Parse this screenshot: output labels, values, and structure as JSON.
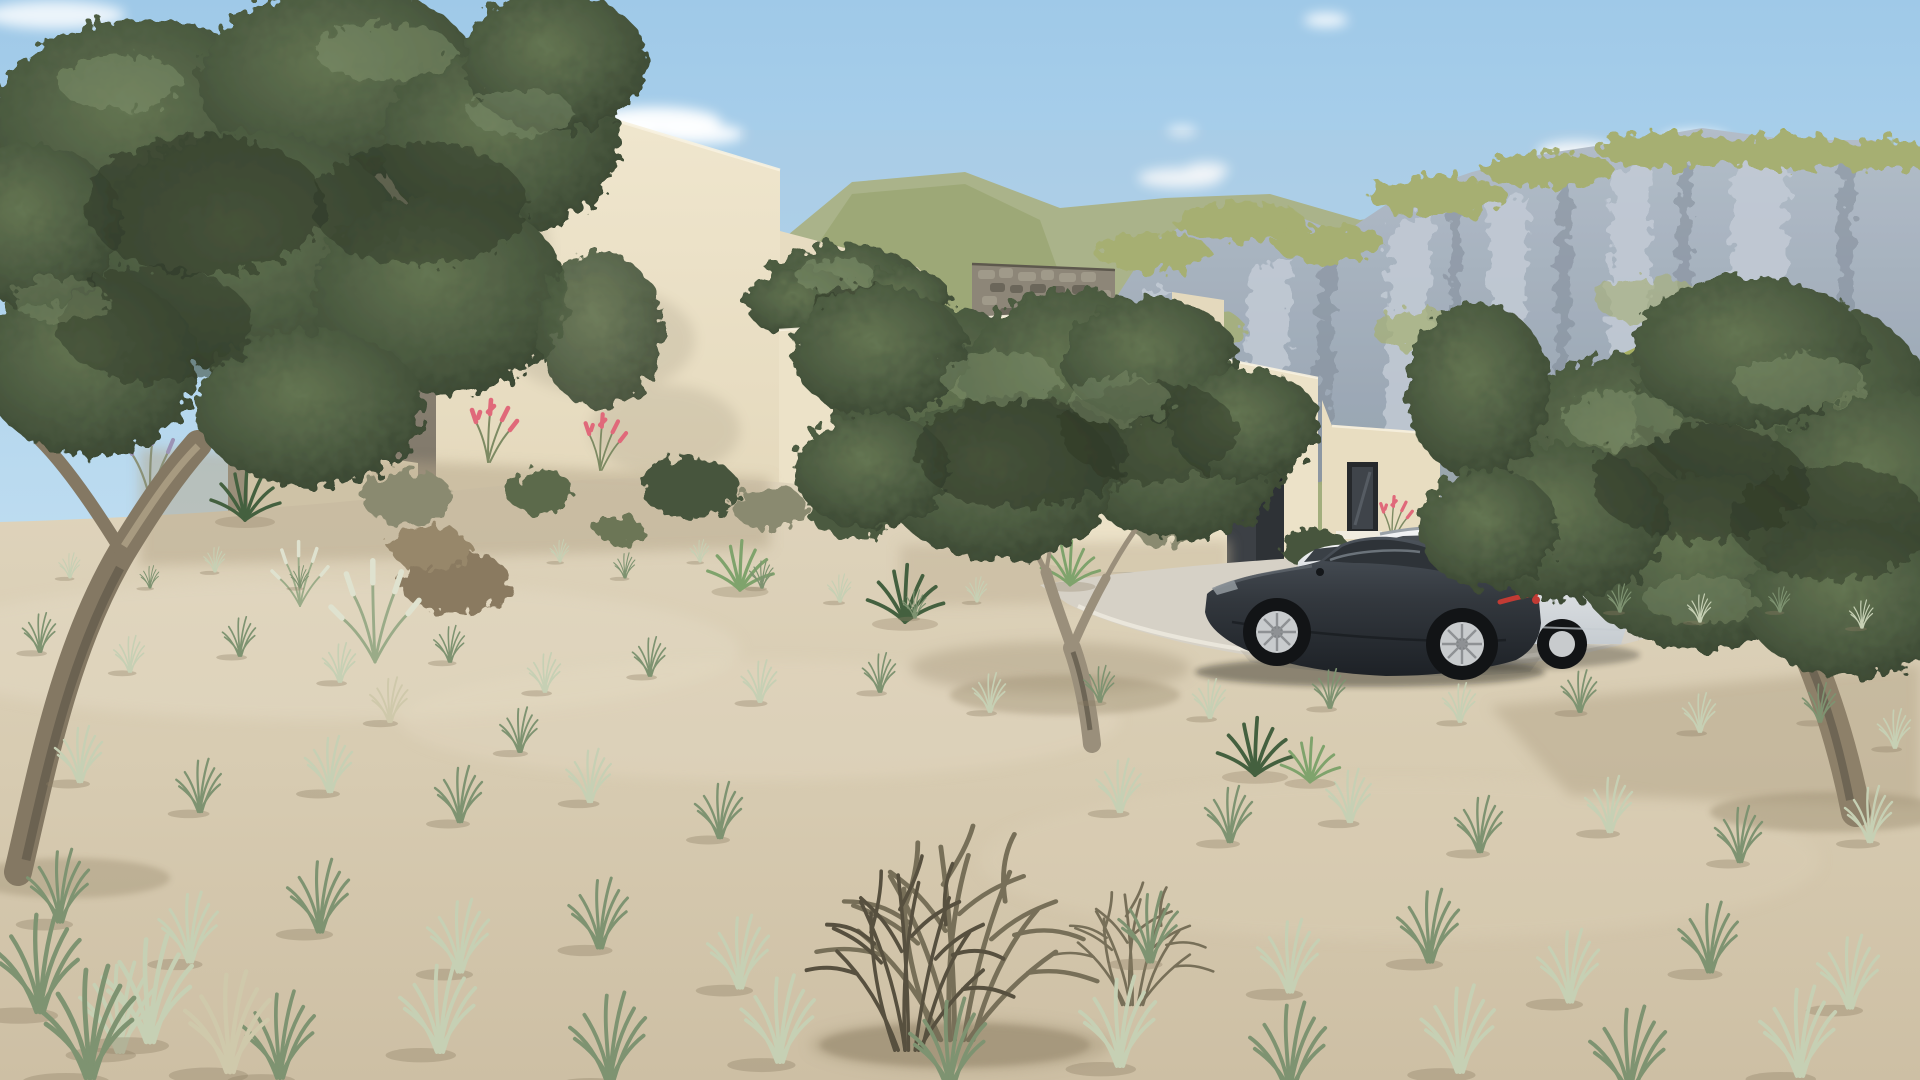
{
  "scene": {
    "title": "Photoreal 3D exterior rendering of a flat-roofed modern stucco villa on an arid hillside with olive trees, desert grasses, rocky green mountains and parked cars",
    "environment": {
      "sky": "clear light-blue sky with a few small white clouds",
      "background": "rocky limestone mountain range with olive-green grassy slopes",
      "midground": "cream stepped single-storey villa volumes, stone accent wall, concrete driveway",
      "foreground": "pale sandy ground with sparse desert grass tufts, dry shrub and gnarled olive trees"
    },
    "objects": [
      {
        "id": "villa",
        "label": "modern cream stucco villa with stepped flat-roofed volumes"
      },
      {
        "id": "roof-overhang",
        "label": "projecting flat roof slab on tall left volume"
      },
      {
        "id": "garage-door",
        "label": "dark recessed garage opening"
      },
      {
        "id": "vertical-window",
        "label": "tall dark-framed window on right wing"
      },
      {
        "id": "stone-wall",
        "label": "rubble stone accent wall behind courtyard"
      },
      {
        "id": "courtyard-trees",
        "label": "green tree crowns rising above courtyard walls"
      },
      {
        "id": "driveway",
        "label": "light concrete parking apron"
      },
      {
        "id": "sports-car",
        "label": "dark charcoal luxury four-door coupe"
      },
      {
        "id": "estate-car",
        "label": "white estate car parked behind the coupe"
      },
      {
        "id": "white-car",
        "label": "partially hidden second white car near garage"
      },
      {
        "id": "olive-tree-left",
        "label": "large gnarled olive tree framing the left edge"
      },
      {
        "id": "olive-tree-center",
        "label": "young olive tree in front of the house"
      },
      {
        "id": "olive-tree-right",
        "label": "large olive tree framing the right edge"
      },
      {
        "id": "planting-bed",
        "label": "gravel bed with yuccas, grey shrubs and pink hesperaloe flower spikes"
      },
      {
        "id": "dry-bush",
        "label": "dead twiggy shrub in the sandy foreground"
      },
      {
        "id": "desert-grasses",
        "label": "sparse pale green grass tufts casting long shadows"
      },
      {
        "id": "mountains",
        "label": "grey rock cliffs with olive-green vegetated tops"
      },
      {
        "id": "foothill",
        "label": "nearer olive-green grassy foothill on the right"
      },
      {
        "id": "clouds",
        "label": "small soft white clouds"
      }
    ],
    "counts": {
      "cars_visible": 3,
      "olive_trees_large": 3,
      "pink_flower_clusters": 4
    }
  },
  "palette": {
    "skyTop": "#9fc9e8",
    "skyLow": "#d2e6f4",
    "cloud": "#ffffff",
    "mtnRockHi": "#c7ced8",
    "mtnRock": "#99a5b2",
    "mtnRockLo": "#78828f",
    "mtnGreen": "#a3ac62",
    "mtnGreenDk": "#8a9551",
    "mtnHaze": "#b9c6d2",
    "hillGreen": "#8d9b52",
    "hillGreenHi": "#a9b264",
    "wallLit": "#ece2c8",
    "wallBright": "#f1e8d0",
    "wallTopLine": "#f8f2e0",
    "wallMid": "#e7dcc1",
    "wallShade": "#dbcfb4",
    "wallDark": "#a99e8b",
    "wallWest": "#948b7d",
    "wallWestLo": "#7b7366",
    "stone": "#8d8678",
    "stoneHi": "#a09a8a",
    "stoneLo": "#6b665a",
    "garage": "#3c4045",
    "garageDk": "#2e3236",
    "frame": "#26292c",
    "glassWin": "#3f444a",
    "sill": "#f0ece0",
    "drive": "#d6d1c6",
    "driveHi": "#ece8dd",
    "driveLo": "#b9b3a6",
    "sandHi": "#e0d6bf",
    "sand": "#d7cbb1",
    "sandLo": "#cdbfa4",
    "sandShadow": "#b3a68a",
    "folDark": "#2e3726",
    "folHi": "#7f916c",
    "trunk": "#8d8069",
    "trunkHi": "#b0a287",
    "trunkDark": "#5a5346",
    "grass": "#7e9371",
    "grassPale": "#c6d0b4",
    "grassDry": "#cfc9ab",
    "plume": "#dfe2cf",
    "dryBush": "#776f58",
    "dryBushDark": "#57503f",
    "pink": "#e0697a",
    "lavender": "#9b93b5",
    "yucca": "#44603f",
    "yuccaHi": "#7fa36c",
    "stemGreen": "#7d8a63",
    "carDarkHi": "#4d545c",
    "carDark": "#23272d",
    "carGlass": "#2e3338",
    "carStreak": "#7b838b",
    "white": "#eef0f1",
    "whiteShade": "#c6ccd1",
    "whiteGlass": "#3a4046",
    "tire": "#121416",
    "wheel": "#c8cbcd",
    "red": "#c23b34"
  }
}
